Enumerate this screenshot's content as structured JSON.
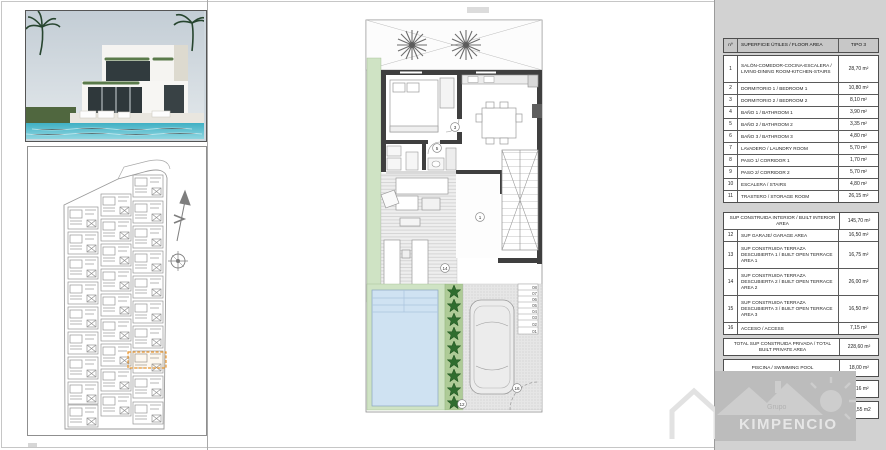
{
  "page": {
    "kind": "architectural plan sheet",
    "unit_type": "TIPO 3"
  },
  "colors": {
    "highlight_orange": "#E8952E",
    "panel_gray": "#d2d2d2",
    "pool_blue": "#cfe2f2",
    "garden_green": "#cfe3c4",
    "plant_green": "#2f6d2f",
    "wall_dark": "#3f3f3f",
    "watermark_gray": "#bcbcbc"
  },
  "floorplan": {
    "callouts": [
      "3",
      "5",
      "1",
      "14",
      "12",
      "16"
    ],
    "step_labels": [
      "08",
      "07",
      "06",
      "05",
      "04",
      "03",
      "02",
      "01"
    ]
  },
  "areas_table": {
    "headers": {
      "num": "nº",
      "label": "SUPERFICIE ÚTILES / FLOOR AREA",
      "type": "TIPO 3"
    },
    "rows": [
      {
        "num": "1",
        "label": "SALÓN-COMEDOR-COCINA-ESCALERA / LIVING-DINING ROOM-KITCHEN-STAIRS",
        "value": "28,70 m²",
        "h": "h3"
      },
      {
        "num": "2",
        "label": "DORMITORIO 1 / BEDROOM 1",
        "value": "10,80 m²",
        "h": "h1"
      },
      {
        "num": "3",
        "label": "DORMITORIO 2 / BEDROOM 2",
        "value": "8,10 m²",
        "h": "h1"
      },
      {
        "num": "4",
        "label": "BAÑO 1 / BATHROOM 1",
        "value": "3,90 m²",
        "h": "h1"
      },
      {
        "num": "5",
        "label": "BAÑO 2 / BATHROOM 2",
        "value": "3,35 m²",
        "h": "h1"
      },
      {
        "num": "6",
        "label": "BAÑO 3 / BATHROOM 3",
        "value": "4,80 m²",
        "h": "h1"
      },
      {
        "num": "7",
        "label": "LAVADERO / LAUNDRY ROOM",
        "value": "5,70 m²",
        "h": "h1"
      },
      {
        "num": "8",
        "label": "PASO 1/ CORRIDOR 1",
        "value": "1,70 m²",
        "h": "h1"
      },
      {
        "num": "9",
        "label": "PASO 2/ CORRIDOR 2",
        "value": "5,70 m²",
        "h": "h1"
      },
      {
        "num": "10",
        "label": "ESCALERA / STAIRS",
        "value": "4,80 m²",
        "h": "h1"
      },
      {
        "num": "11",
        "label": "TRASTERO / STORAGE ROOM",
        "value": "26,15 m²",
        "h": "h1"
      }
    ],
    "built_rows": [
      {
        "num": "",
        "label": "SUP CONSTRUIDA INTERIOR / BUILT INTERIOR AREA",
        "value": "145,70 m²",
        "h": "h2",
        "span": true
      },
      {
        "num": "12",
        "label": "SUP GARAJE/ GARAGE AREA",
        "value": "16,50 m²",
        "h": "h1"
      },
      {
        "num": "13",
        "label": "SUP CONSTRUIDA TERRAZA DESCUBIERTA 1 / BUILT OPEN TERRACE AREA 1",
        "value": "16,75 m²",
        "h": "h3"
      },
      {
        "num": "14",
        "label": "SUP CONSTRUIDA TERRAZA DESCUBIERTA 2 / BUILT OPEN TERRACE AREA 2",
        "value": "26,00 m²",
        "h": "h3"
      },
      {
        "num": "15",
        "label": "SUP CONSTRUIDA TERRAZA DESCUBIERTA 3 / BUILT OPEN TERRACE AREA 3",
        "value": "16,50 m²",
        "h": "h3"
      },
      {
        "num": "16",
        "label": "ACCESO / ACCESS",
        "value": "7,15 m²",
        "h": "h1"
      }
    ],
    "totals": [
      {
        "label": "TOTAL SUP CONSTRUIDA PRIVADA / TOTAL BUILT PRIVATE AREA",
        "value": "228,60 m²",
        "h": "h2"
      },
      {
        "label": "PISCINA / SWIMMING POOL",
        "value": "18,00 m²",
        "h": "h2"
      },
      {
        "label": "SUP. JARDÍN / GARDEN AREA",
        "value": "11,16 m²",
        "h": "h2"
      },
      {
        "label": "SUPERFICIE PARCELA / PLOT AREA",
        "value": "158,55 m2",
        "h": "h2"
      }
    ]
  },
  "watermark": {
    "group": "Grupo",
    "brand": "KIMPENCIO"
  }
}
